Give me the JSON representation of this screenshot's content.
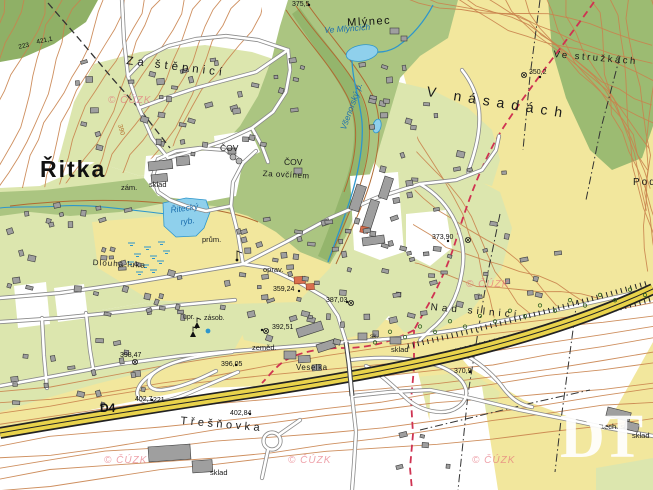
{
  "map": {
    "description": "Czech topographic base map (ZM10 style) of the village Řitka and D4 motorway",
    "logo": {
      "text": "DT"
    },
    "watermark": {
      "text": "© ČÚZK",
      "positions": [
        [
          108,
          95
        ],
        [
          466,
          279
        ],
        [
          104,
          455
        ],
        [
          288,
          455
        ],
        [
          472,
          455
        ]
      ]
    },
    "colors": {
      "field_yellow": "#f2e79d",
      "residential_green": "#dce6ae",
      "forest_green": "#a9c47d",
      "water_blue": "#8fd0ec",
      "contour_brown": "#c9834e",
      "highway_yellow": "#e9d34b",
      "boundary_red": "#cf3352",
      "watermark_pink": "#e4697a"
    },
    "labels": [
      {
        "name": "town-ritka",
        "text": "Řitka",
        "x": 40,
        "y": 158,
        "size": 23,
        "ls": 2,
        "kind": "settlement-large"
      },
      {
        "name": "settlement-mlynec",
        "text": "Mlýnec",
        "x": 347,
        "y": 18,
        "size": 11,
        "ls": 1.5,
        "rot": -3,
        "kind": "settlement"
      },
      {
        "name": "area-za-stepnici",
        "text": "Za štěpnicí",
        "x": 127,
        "y": 56,
        "size": 11.5,
        "ls": 4,
        "rot": 7,
        "kind": "area"
      },
      {
        "name": "area-v-nasadach",
        "text": "V násadách",
        "x": 428,
        "y": 84,
        "size": 14,
        "ls": 7,
        "rot": 9,
        "kind": "area"
      },
      {
        "name": "area-ve-struzkach",
        "text": "Ve stružkách",
        "x": 554,
        "y": 50,
        "size": 9.5,
        "ls": 2.5,
        "rot": 5,
        "kind": "area"
      },
      {
        "name": "area-nad-silnici",
        "text": "Nad silnicí",
        "x": 431,
        "y": 303,
        "size": 10,
        "ls": 4,
        "rot": 5,
        "kind": "area"
      },
      {
        "name": "area-tresnovka",
        "text": "Třešňovka",
        "x": 181,
        "y": 416,
        "size": 11,
        "ls": 3.5,
        "rot": 5,
        "kind": "area"
      },
      {
        "name": "area-pod",
        "text": "Pod",
        "x": 633,
        "y": 178,
        "size": 10,
        "ls": 2,
        "kind": "area"
      },
      {
        "name": "local-dlouha-luka",
        "text": "Dlouhá luka",
        "x": 93,
        "y": 259,
        "size": 8,
        "ls": 1,
        "rot": 3,
        "kind": "local"
      },
      {
        "name": "local-za-ovcinem",
        "text": "Za ovčínem",
        "x": 263,
        "y": 170,
        "size": 8,
        "ls": 0.5,
        "rot": 3,
        "kind": "local"
      },
      {
        "name": "local-cov-west",
        "text": "ČOV",
        "x": 220,
        "y": 144,
        "size": 8.5,
        "kind": "local"
      },
      {
        "name": "local-cov-east",
        "text": "ČOV",
        "x": 284,
        "y": 158,
        "size": 8.5,
        "kind": "local"
      },
      {
        "name": "local-zam",
        "text": "zám.",
        "x": 121,
        "y": 184,
        "size": 7.5,
        "kind": "local"
      },
      {
        "name": "local-sklad-zamek",
        "text": "sklad",
        "x": 149,
        "y": 181,
        "size": 7.5,
        "kind": "local"
      },
      {
        "name": "local-prum",
        "text": "prům.",
        "x": 202,
        "y": 236,
        "size": 7.5,
        "kind": "local"
      },
      {
        "name": "local-oprav",
        "text": "oprav.",
        "x": 263,
        "y": 266,
        "size": 7.5,
        "kind": "local"
      },
      {
        "name": "local-zemed",
        "text": "zeměd.",
        "x": 252,
        "y": 344,
        "size": 7.5,
        "kind": "local"
      },
      {
        "name": "local-veselka",
        "text": "Veselka",
        "x": 296,
        "y": 364,
        "size": 8,
        "ls": 0.5,
        "kind": "local"
      },
      {
        "name": "local-sklad-dalnice",
        "text": "sklad",
        "x": 391,
        "y": 346,
        "size": 7.5,
        "kind": "local"
      },
      {
        "name": "local-sk",
        "text": "sk.",
        "x": 370,
        "y": 334,
        "size": 6.5,
        "kind": "local"
      },
      {
        "name": "local-sklad-tresnovka",
        "text": "sklad",
        "x": 210,
        "y": 469,
        "size": 7.5,
        "kind": "local"
      },
      {
        "name": "local-tech-sl",
        "text": "tech. sl.",
        "x": 602,
        "y": 423,
        "size": 7.5,
        "kind": "local"
      },
      {
        "name": "local-sklad-east",
        "text": "sklad",
        "x": 632,
        "y": 432,
        "size": 7.5,
        "kind": "local"
      },
      {
        "name": "local-upr",
        "text": "upr.",
        "x": 183,
        "y": 314,
        "size": 7,
        "kind": "local"
      },
      {
        "name": "local-zasob",
        "text": "zásob.",
        "x": 204,
        "y": 315,
        "size": 7,
        "kind": "local"
      },
      {
        "name": "road-d4",
        "text": "D4",
        "x": 100,
        "y": 402,
        "size": 12,
        "kind": "road"
      },
      {
        "name": "road-221",
        "text": "221",
        "x": 153,
        "y": 397,
        "size": 7,
        "kind": "elevation"
      },
      {
        "name": "water-ritecky-ryb-line1",
        "text": "Řitecký",
        "x": 170,
        "y": 206,
        "size": 8.5,
        "rot": -8,
        "kind": "water"
      },
      {
        "name": "water-ritecky-ryb-line2",
        "text": "ryb.",
        "x": 180,
        "y": 218,
        "size": 8.5,
        "rot": -8,
        "kind": "water"
      },
      {
        "name": "water-ve-mlyncich",
        "text": "Ve Mlýncích",
        "x": 324,
        "y": 26,
        "size": 8.5,
        "rot": -4,
        "kind": "water"
      },
      {
        "name": "water-vsenorsky-potok",
        "text": "Všenorský p.",
        "x": 339,
        "y": 128,
        "size": 8.5,
        "rot": -70,
        "kind": "water"
      },
      {
        "name": "elev-375-5",
        "text": "375,5",
        "x": 292,
        "y": 1,
        "size": 7,
        "kind": "elevation"
      },
      {
        "name": "elev-223",
        "text": "223",
        "x": 18,
        "y": 45,
        "size": 6.5,
        "rot": -12,
        "kind": "elevation"
      },
      {
        "name": "elev-421-1",
        "text": "421,1",
        "x": 36,
        "y": 40,
        "size": 6.5,
        "rot": -12,
        "kind": "elevation"
      },
      {
        "name": "elev-350-2",
        "text": "350,2",
        "x": 529,
        "y": 69,
        "size": 7,
        "kind": "elevation"
      },
      {
        "name": "elev-373-90",
        "text": "373,90",
        "x": 432,
        "y": 234,
        "size": 7,
        "kind": "elevation"
      },
      {
        "name": "elev-359-24",
        "text": "359,24",
        "x": 273,
        "y": 286,
        "size": 7,
        "kind": "elevation"
      },
      {
        "name": "elev-387-03",
        "text": "387,03",
        "x": 326,
        "y": 297,
        "size": 7,
        "kind": "elevation"
      },
      {
        "name": "elev-392-51",
        "text": "392,51",
        "x": 272,
        "y": 324,
        "size": 7,
        "kind": "elevation"
      },
      {
        "name": "elev-398-47",
        "text": "398,47",
        "x": 120,
        "y": 352,
        "size": 7,
        "kind": "elevation"
      },
      {
        "name": "elev-396-05",
        "text": "396,05",
        "x": 221,
        "y": 361,
        "size": 7,
        "kind": "elevation"
      },
      {
        "name": "elev-402-7",
        "text": "402,7",
        "x": 135,
        "y": 396,
        "size": 7,
        "kind": "elevation"
      },
      {
        "name": "elev-402-84",
        "text": "402,84",
        "x": 230,
        "y": 410,
        "size": 7,
        "kind": "elevation"
      },
      {
        "name": "elev-370-9",
        "text": "370,9",
        "x": 454,
        "y": 368,
        "size": 7,
        "kind": "elevation"
      },
      {
        "name": "contour-390",
        "text": "390",
        "x": 122,
        "y": 124,
        "size": 6.5,
        "rot": 75,
        "kind": "contour"
      }
    ]
  }
}
